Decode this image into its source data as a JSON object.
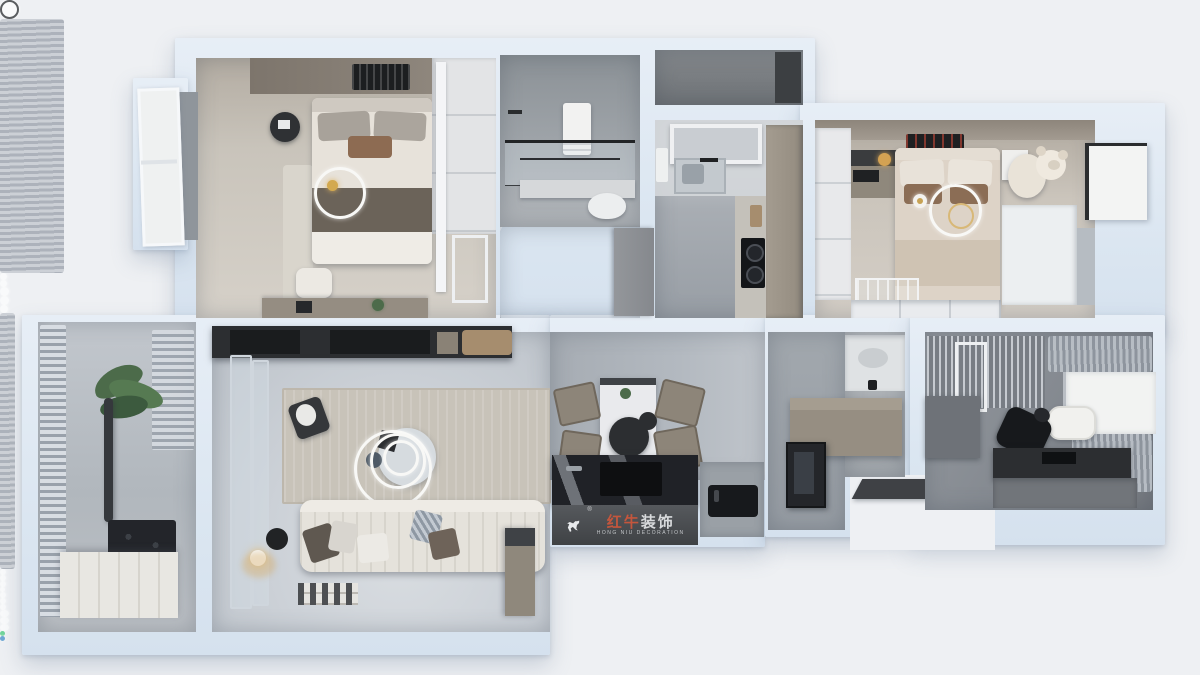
{
  "scene": {
    "type": "3d-floorplan-render",
    "description": "Top-down 3D rendering of a furnished apartment floor plan"
  },
  "watermark": {
    "brand_red": "红牛",
    "brand_white": "装饰",
    "registered": "®",
    "tagline": "HONG NIU DECORATION",
    "logo_icon": "bull-icon"
  },
  "rooms": [
    {
      "id": "master-bedroom"
    },
    {
      "id": "bathroom-1"
    },
    {
      "id": "hallway"
    },
    {
      "id": "kitchen"
    },
    {
      "id": "equipment-balcony"
    },
    {
      "id": "second-bedroom"
    },
    {
      "id": "balcony"
    },
    {
      "id": "living-room"
    },
    {
      "id": "dining-area"
    },
    {
      "id": "island-bar"
    },
    {
      "id": "laundry-bathroom"
    },
    {
      "id": "study"
    },
    {
      "id": "entry-porch"
    }
  ],
  "palette": {
    "background": "#eef0f3",
    "wall": "#dbe6f1",
    "accent_red": "#c4563d",
    "wood": "#a68d6e",
    "taupe": "#968e82",
    "dark_furniture": "#232528",
    "gold": "#d3a94f",
    "plant_green": "#4c6b4a"
  }
}
